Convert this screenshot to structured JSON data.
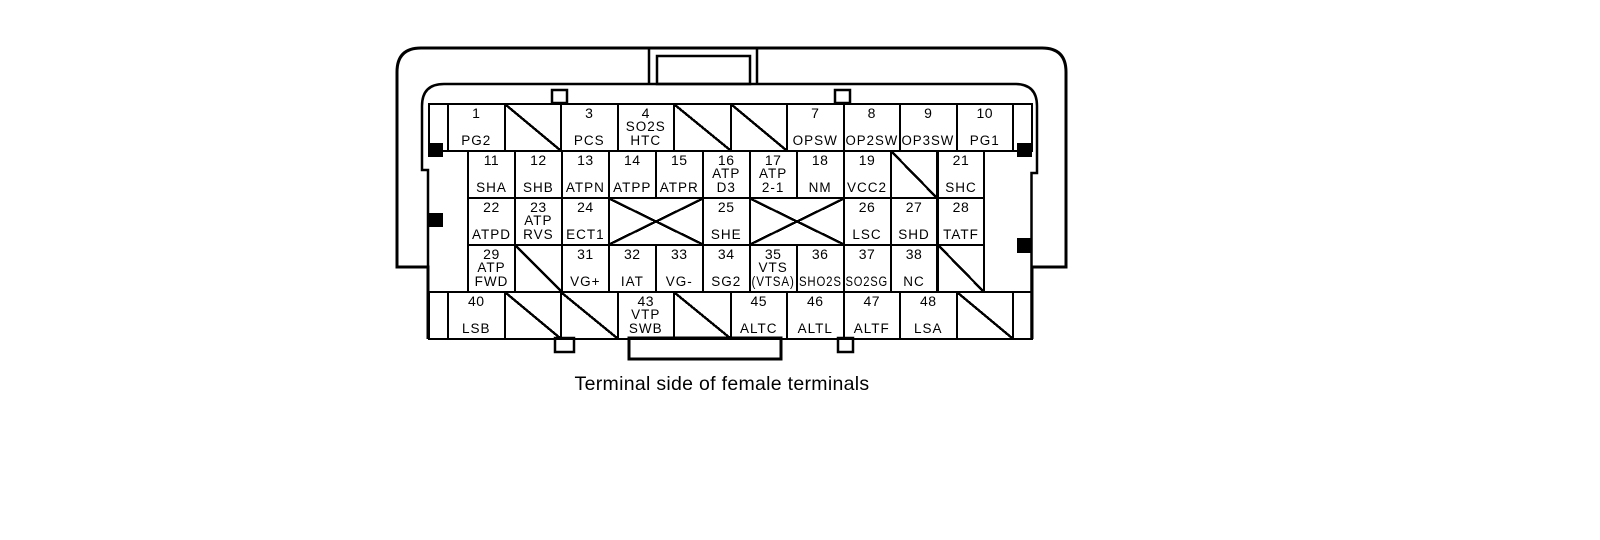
{
  "caption": "Terminal side of female terminals",
  "colors": {
    "line": "#000000",
    "background": "#ffffff"
  },
  "connector": {
    "rows": [
      {
        "kind": "full",
        "cells": [
          {
            "t": "stub"
          },
          {
            "t": "pin",
            "n": "1",
            "l": [
              "PG2"
            ]
          },
          {
            "t": "diag"
          },
          {
            "t": "pin",
            "n": "3",
            "l": [
              "PCS"
            ]
          },
          {
            "t": "pin",
            "n": "4",
            "l": [
              "SO2S",
              "HTC"
            ]
          },
          {
            "t": "diag"
          },
          {
            "t": "diag"
          },
          {
            "t": "pin",
            "n": "7",
            "l": [
              "OPSW"
            ]
          },
          {
            "t": "pin",
            "n": "8",
            "l": [
              "OP2SW"
            ]
          },
          {
            "t": "pin",
            "n": "9",
            "l": [
              "OP3SW"
            ]
          },
          {
            "t": "pin",
            "n": "10",
            "l": [
              "PG1"
            ]
          },
          {
            "t": "stub"
          }
        ]
      },
      {
        "kind": "inset",
        "cells": [
          {
            "t": "pin",
            "n": "11",
            "l": [
              "SHA"
            ]
          },
          {
            "t": "pin",
            "n": "12",
            "l": [
              "SHB"
            ]
          },
          {
            "t": "pin",
            "n": "13",
            "l": [
              "ATPN"
            ]
          },
          {
            "t": "pin",
            "n": "14",
            "l": [
              "ATPP"
            ]
          },
          {
            "t": "pin",
            "n": "15",
            "l": [
              "ATPR"
            ]
          },
          {
            "t": "pin",
            "n": "16",
            "l": [
              "ATP",
              "D3"
            ]
          },
          {
            "t": "pin",
            "n": "17",
            "l": [
              "ATP",
              "2-1"
            ]
          },
          {
            "t": "pin",
            "n": "18",
            "l": [
              "NM"
            ]
          },
          {
            "t": "pin",
            "n": "19",
            "l": [
              "VCC2"
            ]
          },
          {
            "t": "diag"
          },
          {
            "t": "pin",
            "n": "21",
            "l": [
              "SHC"
            ]
          }
        ]
      },
      {
        "kind": "inset",
        "cells": [
          {
            "t": "pin",
            "n": "22",
            "l": [
              "ATPD"
            ]
          },
          {
            "t": "pin",
            "n": "23",
            "l": [
              "ATP",
              "RVS"
            ]
          },
          {
            "t": "pin",
            "n": "24",
            "l": [
              "ECT1"
            ]
          },
          {
            "t": "cross",
            "u": 2
          },
          {
            "t": "pin",
            "n": "25",
            "l": [
              "SHE"
            ]
          },
          {
            "t": "cross",
            "u": 2
          },
          {
            "t": "pin",
            "n": "26",
            "l": [
              "LSC"
            ]
          },
          {
            "t": "pin",
            "n": "27",
            "l": [
              "SHD"
            ]
          },
          {
            "t": "pin",
            "n": "28",
            "l": [
              "TATF"
            ]
          }
        ]
      },
      {
        "kind": "inset",
        "cells": [
          {
            "t": "pin",
            "n": "29",
            "l": [
              "ATP",
              "FWD"
            ]
          },
          {
            "t": "diag"
          },
          {
            "t": "pin",
            "n": "31",
            "l": [
              "VG+"
            ]
          },
          {
            "t": "pin",
            "n": "32",
            "l": [
              "IAT"
            ]
          },
          {
            "t": "pin",
            "n": "33",
            "l": [
              "VG-"
            ]
          },
          {
            "t": "pin",
            "n": "34",
            "l": [
              "SG2"
            ]
          },
          {
            "t": "pin",
            "n": "35",
            "l": [
              "VTS",
              "(VTSA)"
            ]
          },
          {
            "t": "pin",
            "n": "36",
            "l": [
              "SHO2S"
            ]
          },
          {
            "t": "pin",
            "n": "37",
            "l": [
              "SO2SG"
            ]
          },
          {
            "t": "pin",
            "n": "38",
            "l": [
              "NC"
            ]
          },
          {
            "t": "diag"
          }
        ]
      },
      {
        "kind": "full",
        "cells": [
          {
            "t": "stub"
          },
          {
            "t": "pin",
            "n": "40",
            "l": [
              "LSB"
            ]
          },
          {
            "t": "diag"
          },
          {
            "t": "diag"
          },
          {
            "t": "pin",
            "n": "43",
            "l": [
              "VTP",
              "SWB"
            ]
          },
          {
            "t": "diag"
          },
          {
            "t": "pin",
            "n": "45",
            "l": [
              "ALTC"
            ]
          },
          {
            "t": "pin",
            "n": "46",
            "l": [
              "ALTL"
            ]
          },
          {
            "t": "pin",
            "n": "47",
            "l": [
              "ALTF"
            ]
          },
          {
            "t": "pin",
            "n": "48",
            "l": [
              "LSA"
            ]
          },
          {
            "t": "diag"
          },
          {
            "t": "stub"
          }
        ]
      }
    ]
  }
}
